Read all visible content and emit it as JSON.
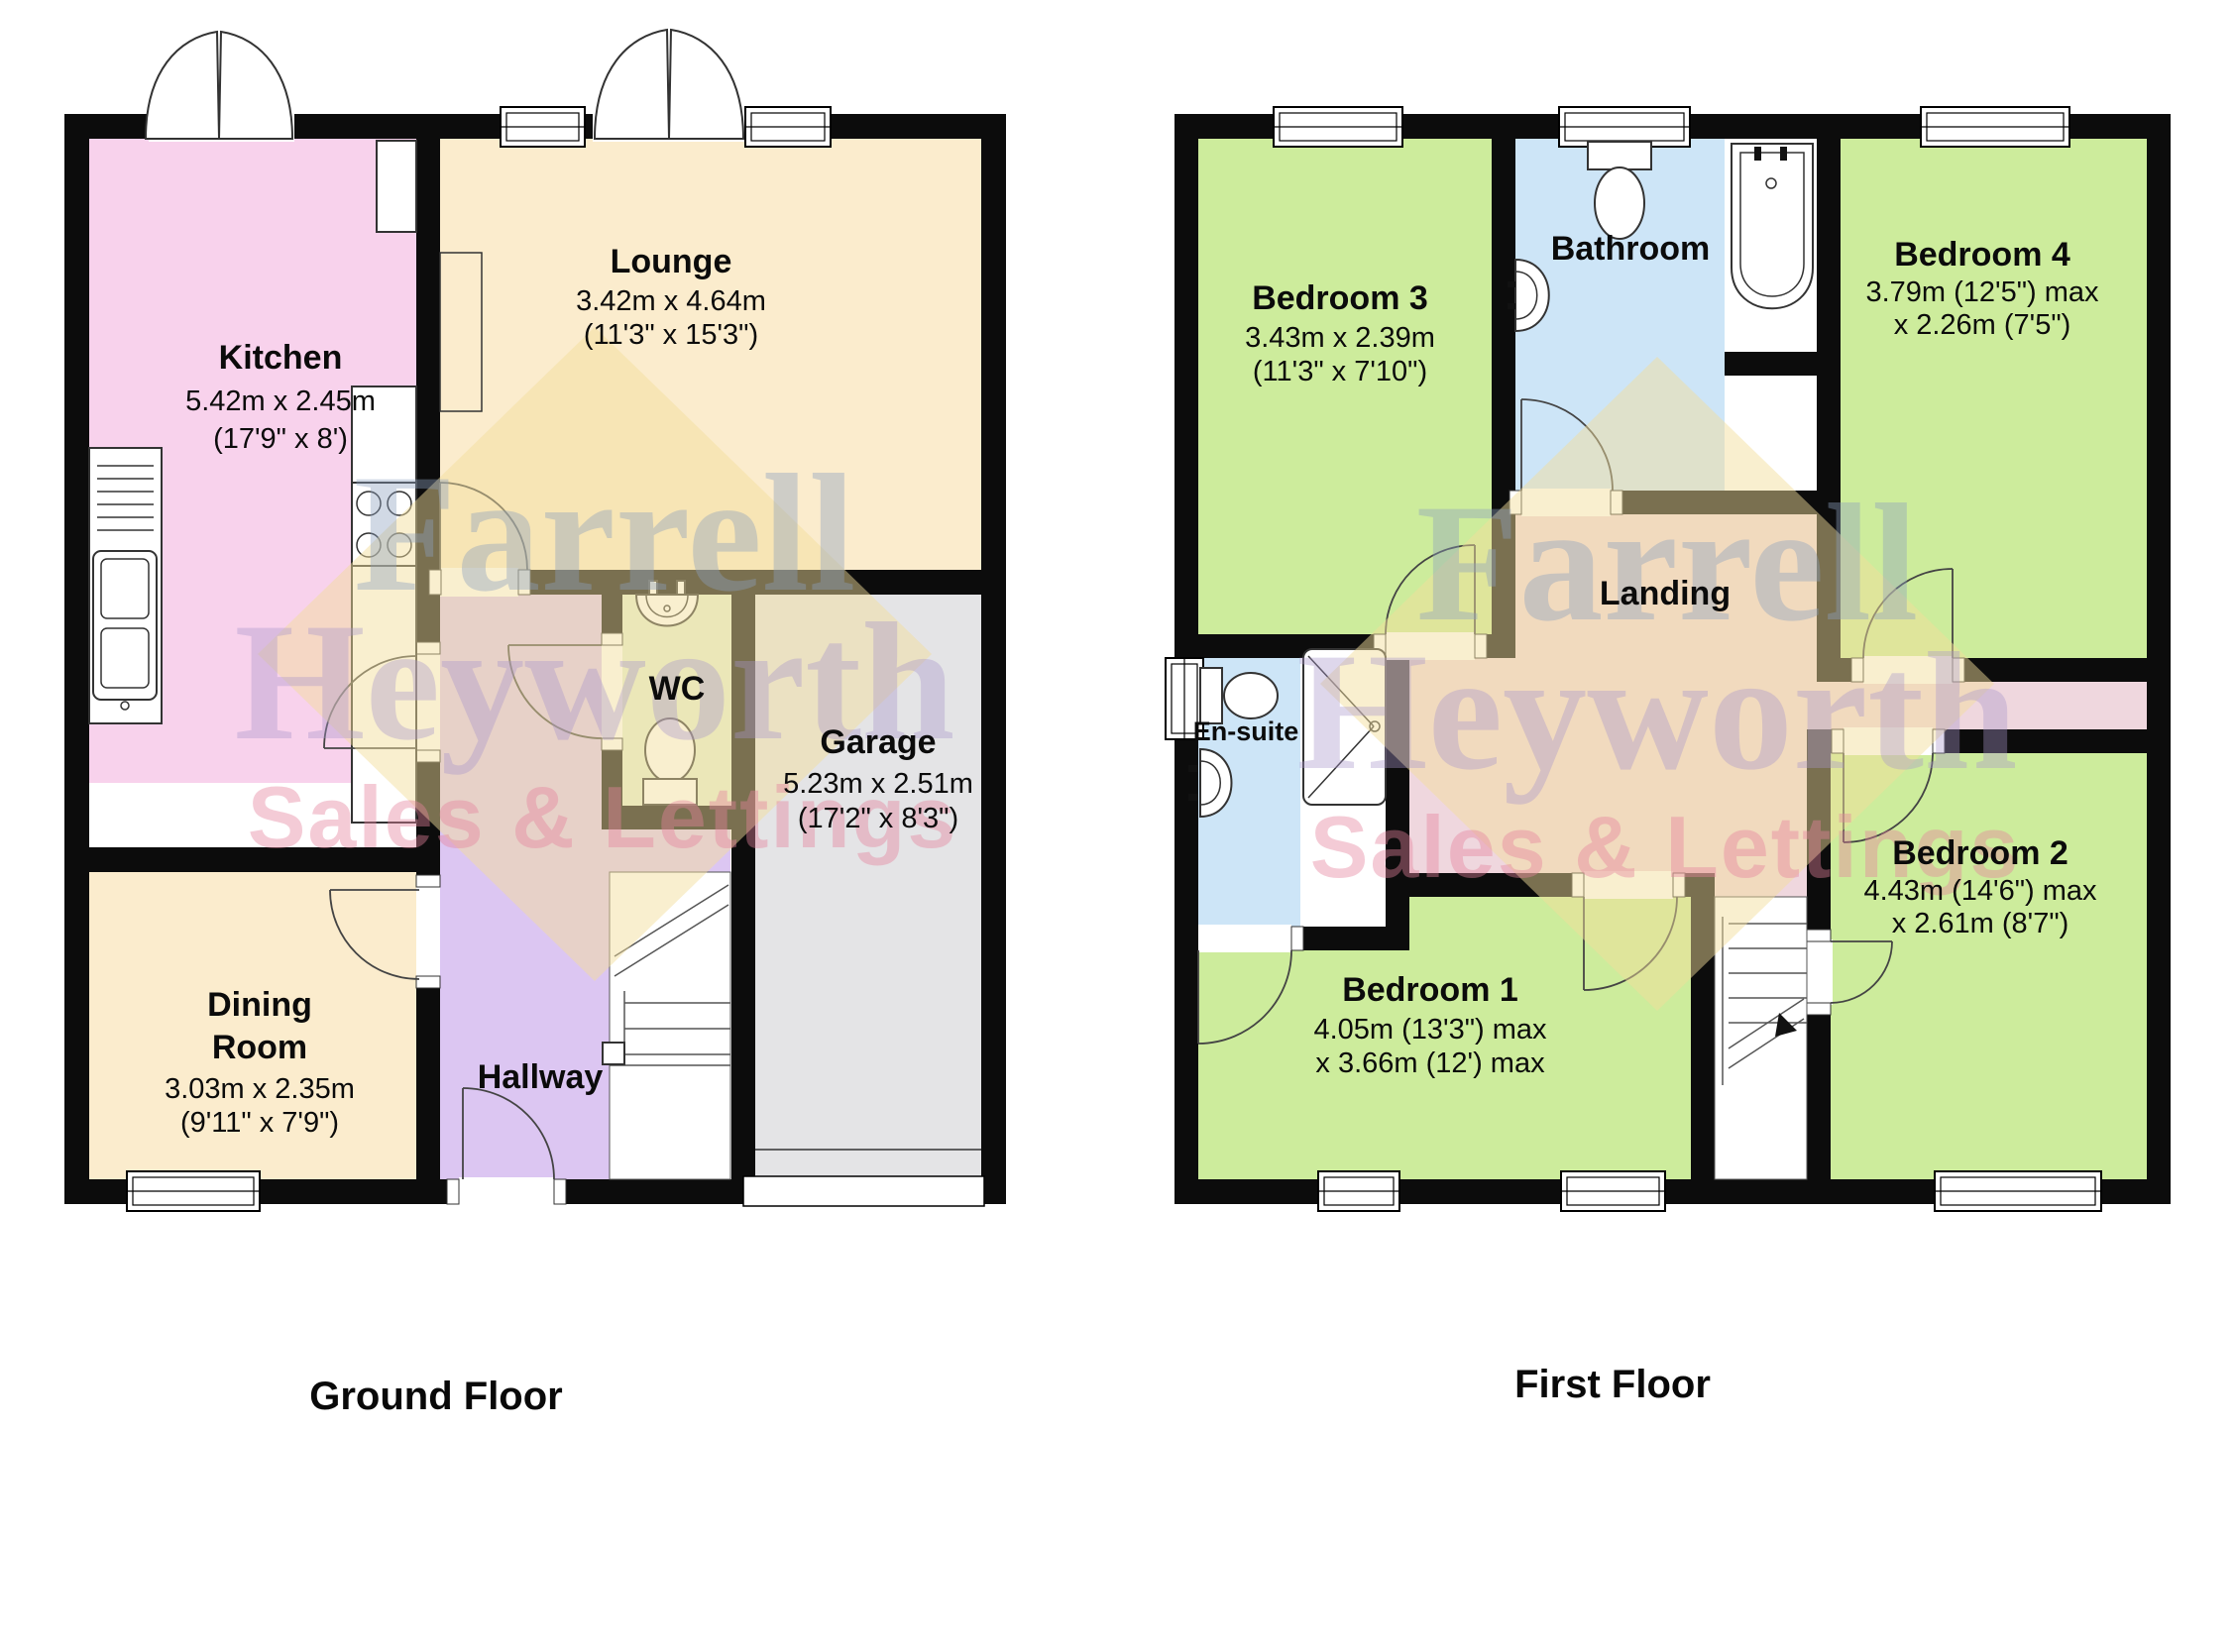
{
  "ground_floor": {
    "title": "Ground Floor",
    "kitchen": {
      "name": "Kitchen",
      "d1": "5.42m x 2.45m",
      "d2": "(17'9\" x 8')"
    },
    "lounge": {
      "name": "Lounge",
      "d1": "3.42m x 4.64m",
      "d2": "(11'3\" x 15'3\")"
    },
    "wc": {
      "name": "WC"
    },
    "garage": {
      "name": "Garage",
      "d1": "5.23m x 2.51m",
      "d2": "(17'2\" x 8'3\")"
    },
    "dining": {
      "name_line1": "Dining",
      "name_line2": "Room",
      "d1": "3.03m x 2.35m",
      "d2": "(9'11\" x 7'9\")"
    },
    "hallway": {
      "name": "Hallway"
    }
  },
  "first_floor": {
    "title": "First Floor",
    "bedroom1": {
      "name": "Bedroom 1",
      "d1": "4.05m (13'3\") max",
      "d2": "x 3.66m (12') max"
    },
    "bedroom2": {
      "name": "Bedroom 2",
      "d1": "4.43m (14'6\") max",
      "d2": "x 2.61m (8'7\")"
    },
    "bedroom3": {
      "name": "Bedroom 3",
      "d1": "3.43m x 2.39m",
      "d2": "(11'3\" x 7'10\")"
    },
    "bedroom4": {
      "name": "Bedroom 4",
      "d1": "3.79m (12'5\") max",
      "d2": "x 2.26m (7'5\")"
    },
    "bathroom": {
      "name": "Bathroom"
    },
    "ensuite": {
      "name": "En-suite"
    },
    "landing": {
      "name": "Landing"
    }
  },
  "watermark": {
    "line1": "Farrell",
    "line2": "Heyworth",
    "line3": "Sales & Lettings"
  },
  "colors": {
    "wall": "#0c0c0c",
    "kitchen": "#f8d2ec",
    "lounge_dining": "#fbeccd",
    "hallway": "#dcc6f2",
    "wc": "#e4efd3",
    "garage": "#e4e4e6",
    "bedroom": "#cdec9c",
    "bathroom": "#cde5f7",
    "landing": "#efd7de",
    "watermark_yellow": "#f2dd9b",
    "watermark_blue": "#8ba0bd",
    "watermark_purple": "#a795cb",
    "watermark_pink": "#e4849d"
  }
}
